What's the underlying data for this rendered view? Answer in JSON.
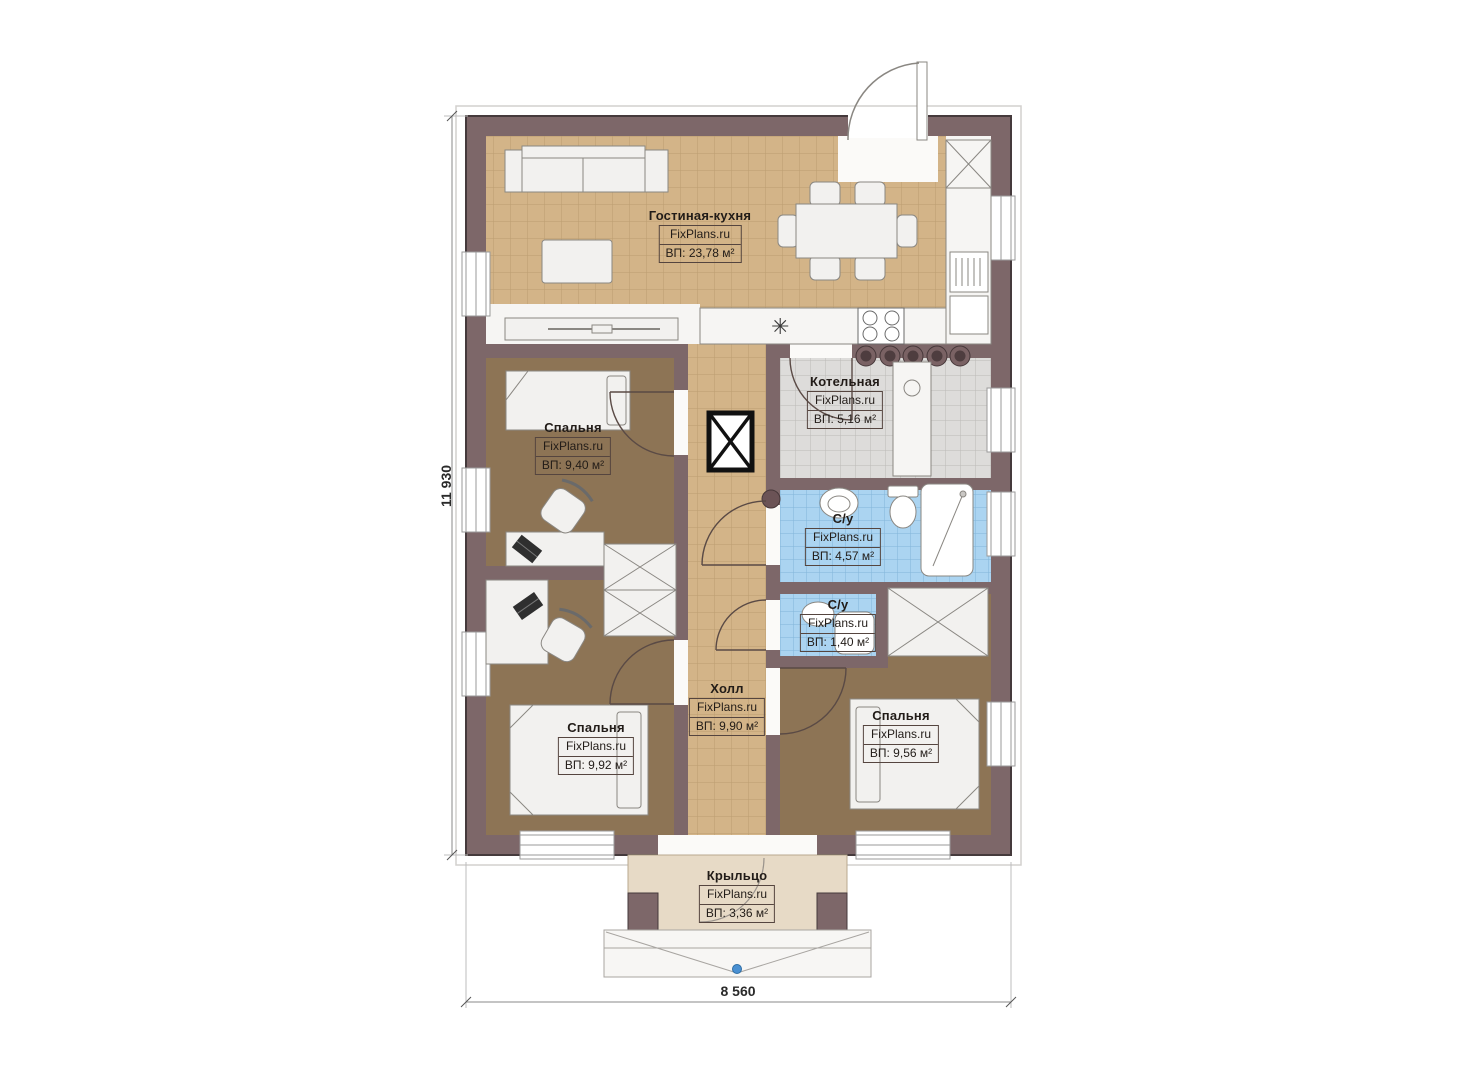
{
  "plan": {
    "title": "floor-plan",
    "rooms": [
      {
        "id": "living-kitchen",
        "name": "Гостиная-кухня",
        "brand": "FixPlans.ru",
        "area": "ВП: 23,78 м²"
      },
      {
        "id": "boiler-room",
        "name": "Котельная",
        "brand": "FixPlans.ru",
        "area": "ВП: 5,16 м²"
      },
      {
        "id": "bedroom-1",
        "name": "Спальня",
        "brand": "FixPlans.ru",
        "area": "ВП: 9,40 м²"
      },
      {
        "id": "bathroom-1",
        "name": "С/у",
        "brand": "FixPlans.ru",
        "area": "ВП: 4,57 м²"
      },
      {
        "id": "bathroom-2",
        "name": "С/у",
        "brand": "FixPlans.ru",
        "area": "ВП: 1,40 м²"
      },
      {
        "id": "hall",
        "name": "Холл",
        "brand": "FixPlans.ru",
        "area": "ВП: 9,90 м²"
      },
      {
        "id": "bedroom-2",
        "name": "Спальня",
        "brand": "FixPlans.ru",
        "area": "ВП: 9,92 м²"
      },
      {
        "id": "bedroom-3",
        "name": "Спальня",
        "brand": "FixPlans.ru",
        "area": "ВП: 9,56 м²"
      },
      {
        "id": "porch",
        "name": "Крыльцо",
        "brand": "FixPlans.ru",
        "area": "ВП: 3,36 м²"
      }
    ],
    "dimensions": {
      "height": "11 930",
      "width": "8 560"
    },
    "colors": {
      "wall": "#7d6769",
      "wall_outline": "#453a3c",
      "tile_beige": "#d3b488",
      "tile_beige_line": "#bb9d70",
      "floor_bedroom": "#8d7455",
      "tile_bath": "#abd4f1",
      "tile_bath_line": "#82b5d9",
      "tile_boiler": "#dddcda",
      "tile_boiler_line": "#bcbab7",
      "porch_floor": "#e7dac6",
      "furniture": "#f2f1ef",
      "marker_blue": "#4a90d2"
    }
  }
}
